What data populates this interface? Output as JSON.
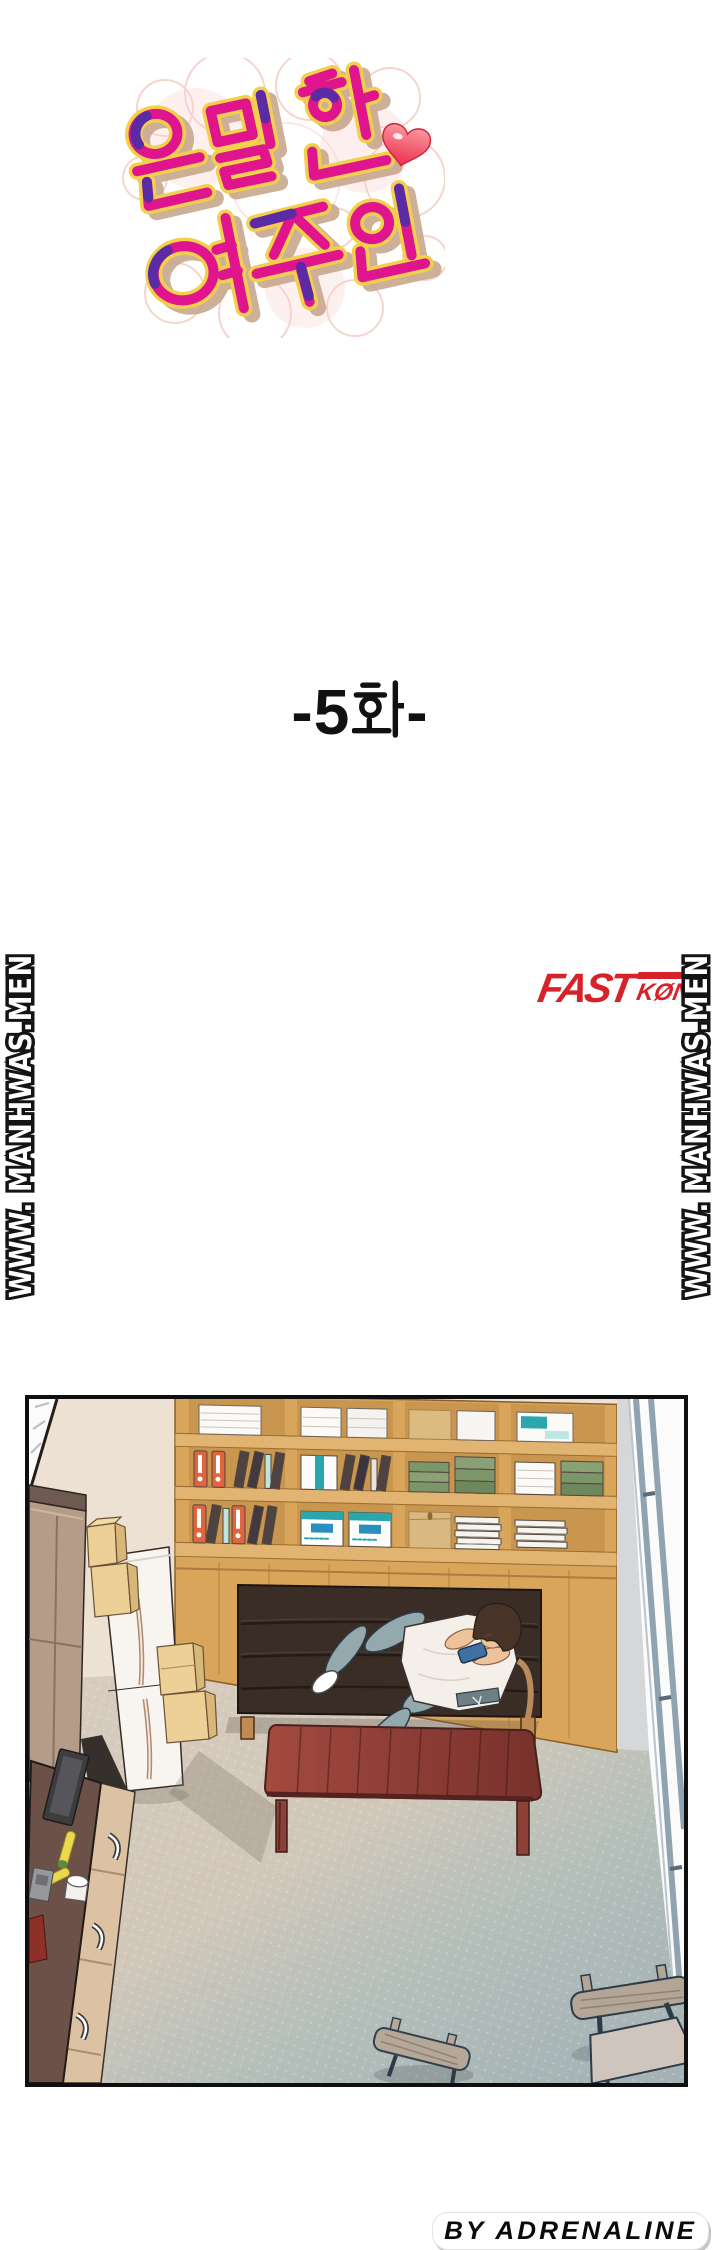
{
  "page": {
    "bg_color": "#ffffff",
    "title": {
      "text": "은밀한 여주인",
      "line1": "은밀한",
      "line2": "여주인",
      "colors": {
        "fill": "#e0148c",
        "accent": "#5b2aa5",
        "outline": "#f2cf4d",
        "shadow": "#c7a88d",
        "bubbles": "#f4c6be",
        "heart": "#ef3a52"
      }
    },
    "episode": {
      "label": "-5화-",
      "prefix": "-5",
      "hangul_glyph": "화",
      "suffix": "-",
      "color": "#111111"
    },
    "logo": {
      "main": "FAST",
      "sub": "KØN",
      "color": "#d6232a"
    },
    "watermarks": {
      "text": "WWW. MANHWAS.MEN",
      "positions": [
        "left",
        "right"
      ],
      "style": "white bubble letters with black outline, rotated, reads bottom to top"
    },
    "credit": {
      "text": "BY ADRENALINE",
      "color": "#0a0a0a",
      "bg": "#ffffff"
    }
  },
  "panel": {
    "border_color": "#0f0f0f",
    "scene": "overhead view of a room: wooden bookshelf full of binders and boxes, dark brown sofa with a young man in white t-shirt and blue-gray sweatpants lying down using a blue smartphone, mahogany coffee table, white fridge, brown wardrobe, stacked cardboard boxes, dark desk with drawers and stationery, two wooden chairs on blue-gray carpet, bright window wall at right",
    "colors": {
      "wall": "#ece1d2",
      "shelf_wood": "#d8a55b",
      "sofa": "#3a2d26",
      "table": "#8f3d35",
      "floor_left": "#d6cbbc",
      "floor_right": "#a7b5b8",
      "window_frame": "#8fa3b0",
      "shirt": "#f4efe8",
      "pants": "#93a9ad",
      "phone": "#3f6fa3",
      "binder_orange": "#e0643e",
      "file_teal": "#2aa6ad",
      "books_green": "#7c9569",
      "box_tan": "#ecd095",
      "wardrobe": "#b59c89",
      "desk": "#6b5147",
      "drawer_tan": "#dcc1a3"
    }
  }
}
